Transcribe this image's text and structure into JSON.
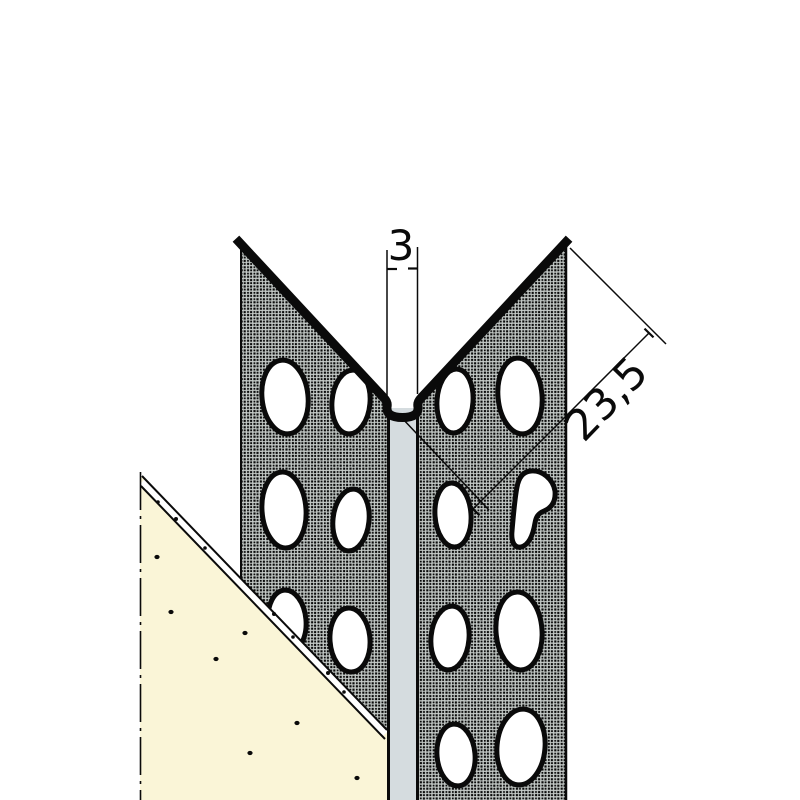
{
  "drawing": {
    "dimension_labels": {
      "corner_gap_width": "3",
      "flange_width": "23,5"
    },
    "colors": {
      "flange_fill": "#c9cfcc",
      "plaster_fill": "#faf5d7",
      "strip_fill": "#d5dcdf",
      "hole_fill": "#ffffff",
      "line": "#0a0a0a"
    }
  }
}
